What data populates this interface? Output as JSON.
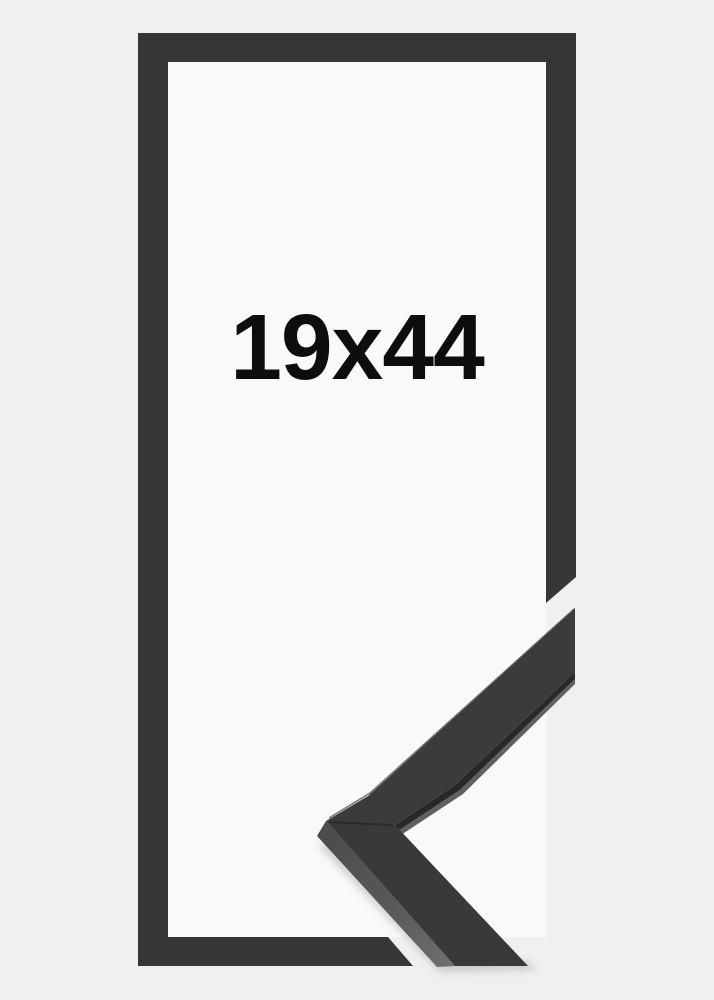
{
  "product": {
    "size_label": "19x44"
  },
  "frame": {
    "background_color": "#f0f0f1",
    "interior_color": "#f9f9fa",
    "outline_color": "#363638"
  },
  "corner_sample": {
    "front_color_upper": "#3b3b3d",
    "front_color_lower": "#39393b",
    "side_gradient_start": "#4c4c4e",
    "side_gradient_end": "#6e6e70",
    "under_edge_dark": "#28282a",
    "under_edge_light": "#606062",
    "seam_color": "#29292b",
    "top_highlight_color": "#525254",
    "shadow_color": "#bdbdbf"
  },
  "label": {
    "text_color": "#0d0d0d"
  }
}
